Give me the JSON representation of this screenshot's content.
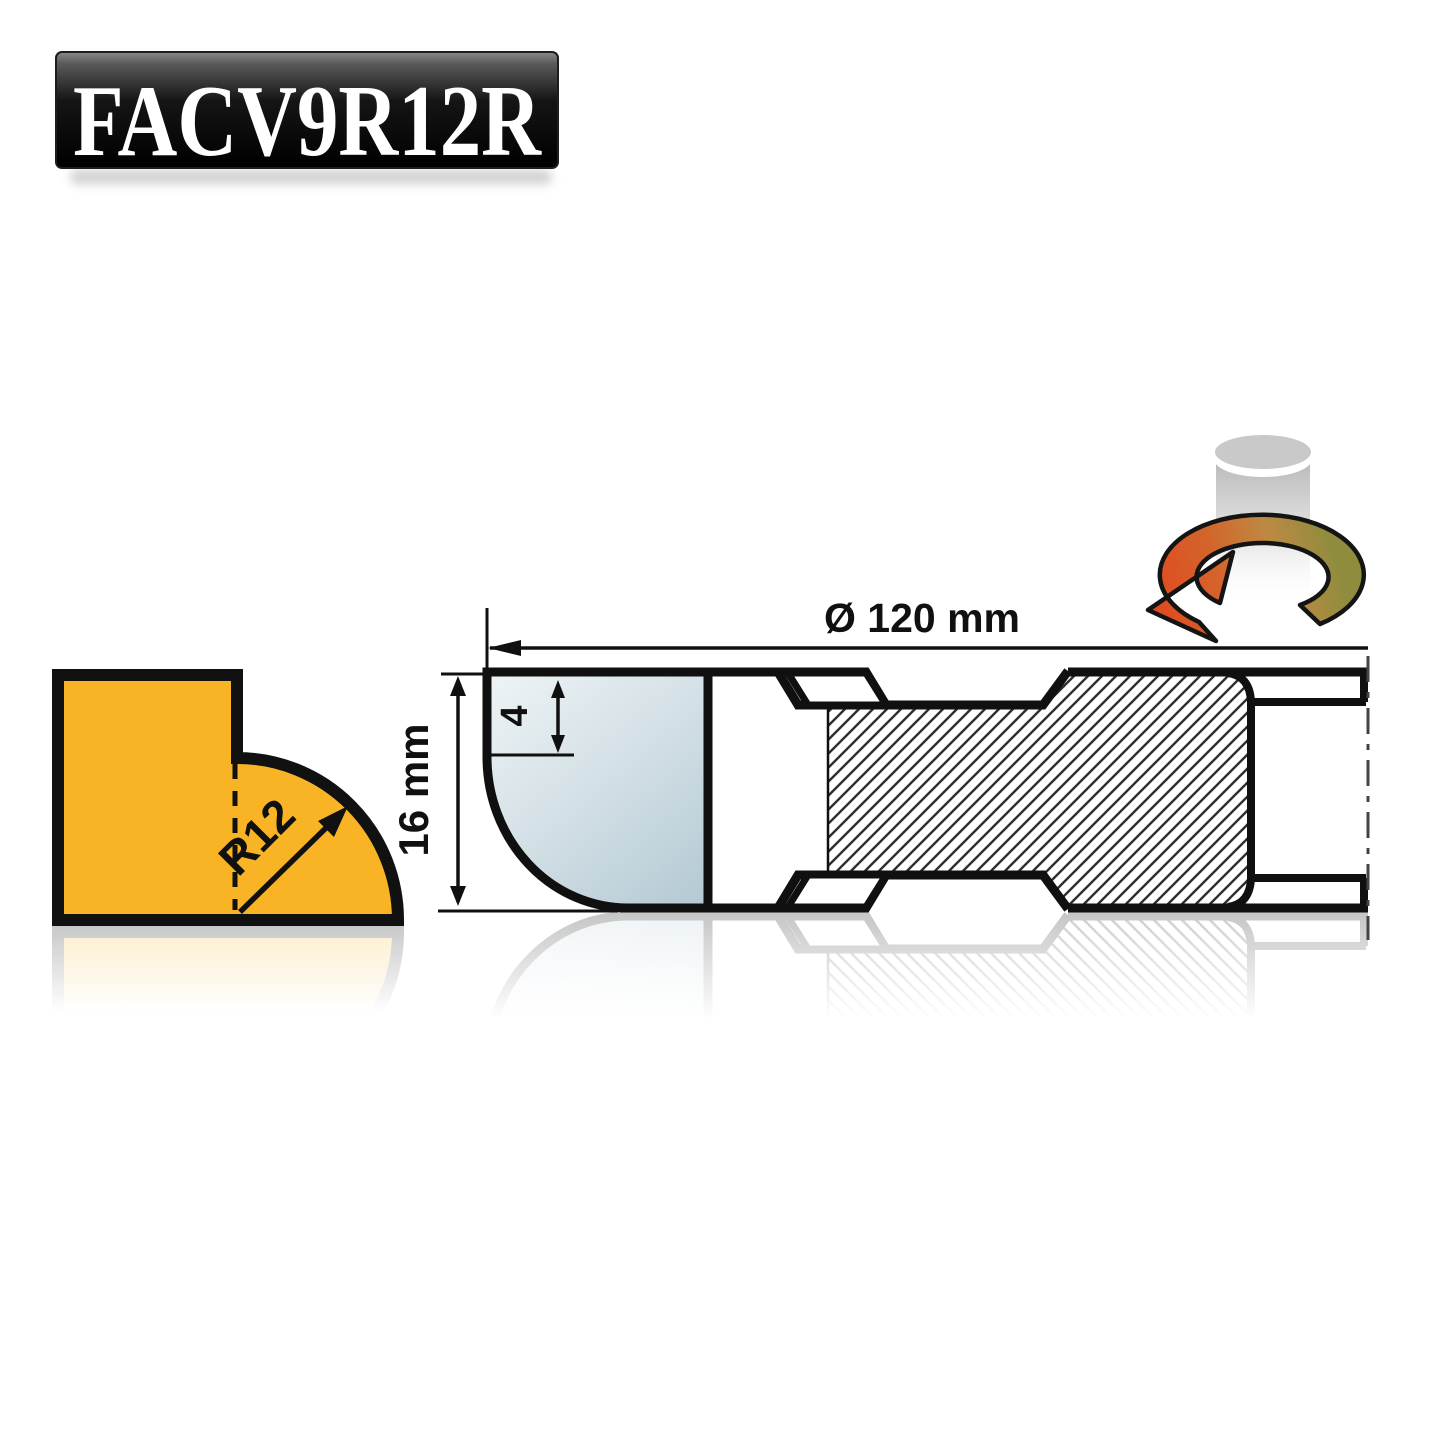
{
  "plaque": {
    "code": "FACV9R12R",
    "text_color": "#ffffff",
    "bg_top": "#5a5a5a",
    "bg_bottom": "#000000"
  },
  "profile": {
    "radius_label": "R12",
    "fill": "#F8B425",
    "outline": "#111111"
  },
  "section": {
    "diameter_label": "Ø 120 mm",
    "height_label": "16 mm",
    "step_label": "4",
    "line_color": "#101010",
    "knife_light": "#edf3f5",
    "knife_dark": "#b4c9d4"
  },
  "rotation_icon": {
    "arrow_start_color": "#e2481f",
    "arrow_end_color": "#8f8c3e",
    "cylinder_color": "#b3b3b3"
  }
}
